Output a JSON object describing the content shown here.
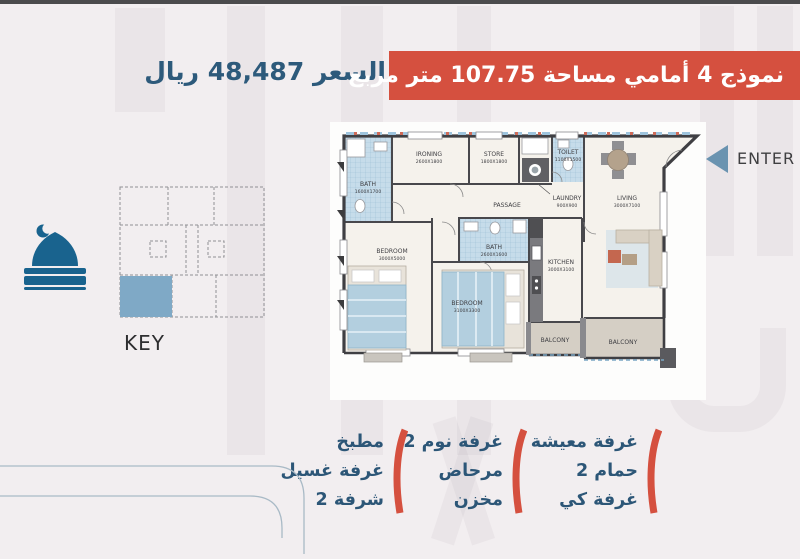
{
  "header": {
    "title": "نموذج 4 أمامي مساحة 107.75 متر مربع",
    "price": "السعر 48,487 ريال"
  },
  "colors": {
    "accent_red": "#d5503f",
    "brand_blue": "#2d5a7b",
    "mosque_blue": "#19638e",
    "key_unit_fill": "#7fa9c6"
  },
  "key_plan": {
    "label": "KEY"
  },
  "enter": {
    "label": "ENTER"
  },
  "floor_plan": {
    "rooms": [
      {
        "name": "bath-1",
        "label": "BATH",
        "dims": "1600X1700"
      },
      {
        "name": "ironing",
        "label": "IRONING",
        "dims": "2600X1800"
      },
      {
        "name": "store",
        "label": "STORE",
        "dims": "1800X1800"
      },
      {
        "name": "toilet",
        "label": "TOILET",
        "dims": "1100X1500"
      },
      {
        "name": "laundry",
        "label": "LAUNDRY",
        "dims": "900X900"
      },
      {
        "name": "passage",
        "label": "PASSAGE",
        "dims": ""
      },
      {
        "name": "living",
        "label": "LIVING",
        "dims": "3000X7100"
      },
      {
        "name": "bedroom-1",
        "label": "BEDROOM",
        "dims": "3000X5000"
      },
      {
        "name": "bath-2",
        "label": "BATH",
        "dims": "2600X1600"
      },
      {
        "name": "bedroom-2",
        "label": "BEDROOM",
        "dims": "3100X3300"
      },
      {
        "name": "kitchen",
        "label": "KITCHEN",
        "dims": "3000X3100"
      },
      {
        "name": "balcony-1",
        "label": "BALCONY",
        "dims": ""
      },
      {
        "name": "balcony-2",
        "label": "BALCONY",
        "dims": ""
      }
    ]
  },
  "features": {
    "column_right": [
      "غرفة معيشة",
      "2 حمام",
      "غرفة كي"
    ],
    "column_middle": [
      "2 غرفة نوم",
      "مرحاض",
      "مخزن"
    ],
    "column_left": [
      "مطبخ",
      "غرفة غسيل",
      "2 شرفة"
    ]
  }
}
